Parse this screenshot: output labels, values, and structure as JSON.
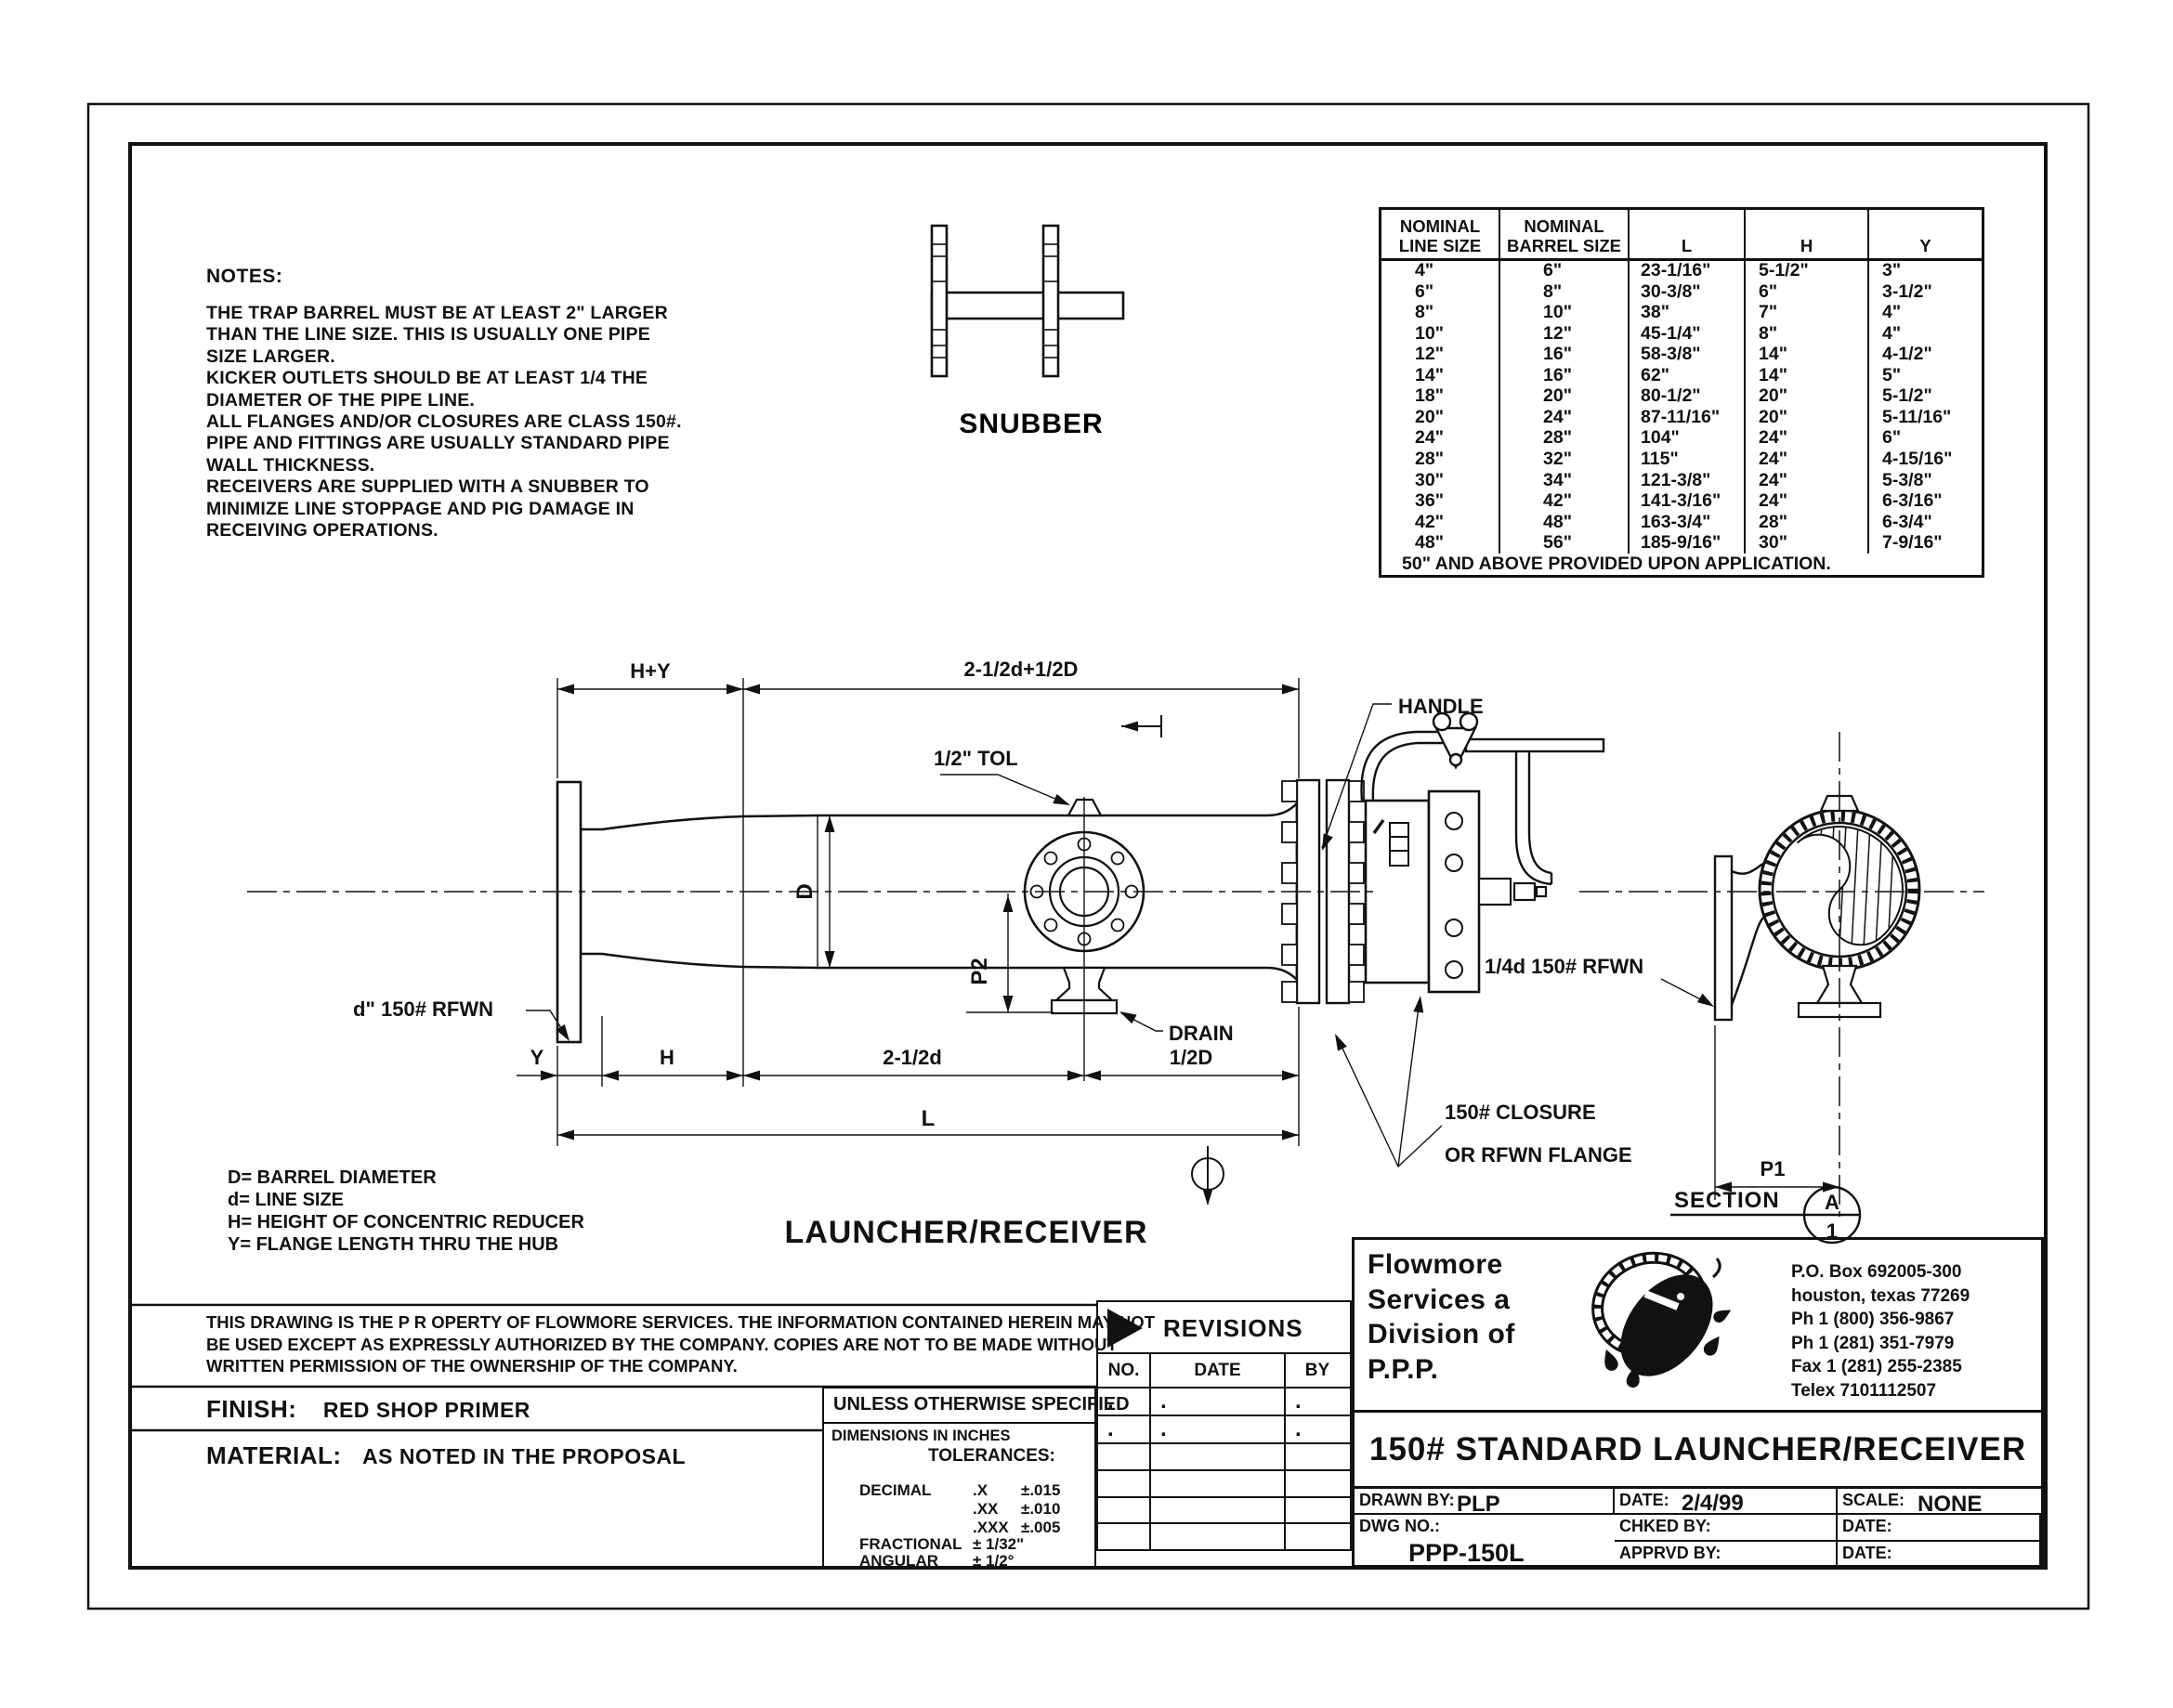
{
  "notes": {
    "heading": "NOTES:",
    "lines": [
      "THE TRAP BARREL MUST BE AT LEAST 2\" LARGER",
      "THAN THE LINE SIZE. THIS IS USUALLY ONE PIPE",
      "SIZE LARGER.",
      "KICKER OUTLETS SHOULD BE AT LEAST 1/4 THE",
      "DIAMETER OF THE PIPE LINE.",
      "ALL FLANGES AND/OR CLOSURES ARE CLASS 150#.",
      "PIPE AND FITTINGS ARE USUALLY STANDARD PIPE",
      "WALL THICKNESS.",
      "RECEIVERS ARE SUPPLIED WITH A SNUBBER TO",
      "MINIMIZE LINE STOPPAGE AND PIG DAMAGE IN",
      "RECEIVING OPERATIONS."
    ]
  },
  "size_table": {
    "headers": [
      [
        "NOMINAL",
        "LINE SIZE"
      ],
      [
        "NOMINAL",
        "BARREL SIZE"
      ],
      [
        "",
        "L"
      ],
      [
        "",
        "H"
      ],
      [
        "",
        "Y"
      ]
    ],
    "rows": [
      [
        "4\"",
        "6\"",
        "23-1/16\"",
        "5-1/2\"",
        "3\""
      ],
      [
        "6\"",
        "8\"",
        "30-3/8\"",
        "6\"",
        "3-1/2\""
      ],
      [
        "8\"",
        "10\"",
        "38\"",
        "7\"",
        "4\""
      ],
      [
        "10\"",
        "12\"",
        "45-1/4\"",
        "8\"",
        "4\""
      ],
      [
        "12\"",
        "16\"",
        "58-3/8\"",
        "14\"",
        "4-1/2\""
      ],
      [
        "14\"",
        "16\"",
        "62\"",
        "14\"",
        "5\""
      ],
      [
        "18\"",
        "20\"",
        "80-1/2\"",
        "20\"",
        "5-1/2\""
      ],
      [
        "20\"",
        "24\"",
        "87-11/16\"",
        "20\"",
        "5-11/16\""
      ],
      [
        "24\"",
        "28\"",
        "104\"",
        "24\"",
        "6\""
      ],
      [
        "28\"",
        "32\"",
        "115\"",
        "24\"",
        "4-15/16\""
      ],
      [
        "30\"",
        "34\"",
        "121-3/8\"",
        "24\"",
        "5-3/8\""
      ],
      [
        "36\"",
        "42\"",
        "141-3/16\"",
        "24\"",
        "6-3/16\""
      ],
      [
        "42\"",
        "48\"",
        "163-3/4\"",
        "28\"",
        "6-3/4\""
      ],
      [
        "48\"",
        "56\"",
        "185-9/16\"",
        "30\"",
        "7-9/16\""
      ]
    ],
    "footer": "50\" AND ABOVE PROVIDED UPON APPLICATION."
  },
  "drawing": {
    "title": "LAUNCHER/RECEIVER",
    "snubber_label": "SNUBBER",
    "dim_top_left": "H+Y",
    "dim_top_right": "2-1/2d+1/2D",
    "tol": "1/2\" TOL",
    "barrel_dia": "D",
    "p2": "P2",
    "drain": "DRAIN",
    "handle": "HANDLE",
    "closure_line1": "150# CLOSURE",
    "closure_line2": "OR RFWN FLANGE",
    "quarter_rfwn": "1/4d 150# RFWN",
    "line_rfwn": "d\" 150# RFWN",
    "dim_y": "Y",
    "dim_h": "H",
    "dim_25d": "2-1/2d",
    "dim_12d": "1/2D",
    "dim_l": "L",
    "dim_p1": "P1",
    "section_label": "SECTION",
    "section_letter": "A",
    "section_number": "1"
  },
  "legend": {
    "lines": [
      "D=  BARREL DIAMETER",
      "d=  LINE SIZE",
      "H=  HEIGHT OF CONCENTRIC REDUCER",
      "Y=  FLANGE LENGTH THRU THE HUB"
    ]
  },
  "property_note": {
    "lines": [
      "THIS DRAWING IS THE P R OPERTY OF FLOWMORE SERVICES.   THE INFORMATION CONTAINED HEREIN MAY NOT",
      "BE USED EXCEPT AS EXPRESSLY AUTHORIZED BY THE COMPANY. COPIES ARE NOT TO BE MADE WITHOUT",
      "WRITTEN PERMISSION OF THE OWNERSHIP OF THE COMPANY."
    ]
  },
  "finish": {
    "label": "FINISH:",
    "value": "RED SHOP PRIMER"
  },
  "material": {
    "label": "MATERIAL:",
    "value": "AS NOTED IN THE PROPOSAL"
  },
  "tolerances": {
    "unless": "UNLESS OTHERWISE SPECIFIED",
    "dims_in": "DIMENSIONS IN INCHES",
    "heading": "TOLERANCES:",
    "decimal_label": "DECIMAL",
    "dec_rows": [
      {
        "k": ".X",
        "v": "±.015"
      },
      {
        "k": ".XX",
        "v": "±.010"
      },
      {
        "k": ".XXX",
        "v": "±.005"
      }
    ],
    "fractional_label": "FRACTIONAL",
    "fractional_value": "± 1/32\"",
    "angular_label": "ANGULAR",
    "angular_value": "± 1/2°"
  },
  "revisions": {
    "title": "REVISIONS",
    "columns": [
      "NO.",
      "DATE",
      "BY"
    ],
    "rows": [
      [
        ".",
        ".",
        "."
      ],
      [
        ".",
        ".",
        "."
      ],
      [
        "",
        "",
        ""
      ],
      [
        "",
        "",
        ""
      ],
      [
        "",
        "",
        ""
      ],
      [
        "",
        "",
        ""
      ]
    ]
  },
  "title_block": {
    "company_lines": [
      "Flowmore",
      "Services a",
      "Division of",
      "P.P.P."
    ],
    "address_lines": [
      "P.O. Box 692005-300",
      "houston, texas 77269",
      "Ph 1 (800) 356-9867",
      "Ph 1 (281) 351-7979",
      "Fax 1 (281) 255-2385",
      "Telex 7101112507"
    ],
    "drawing_title": "150# STANDARD LAUNCHER/RECEIVER",
    "drawn_by_label": "DRAWN BY:",
    "drawn_by": "PLP",
    "date1_label": "DATE:",
    "date1": "2/4/99",
    "scale_label": "SCALE:",
    "scale": "NONE",
    "chked_label": "CHKED BY:",
    "date2_label": "DATE:",
    "dwg_label": "DWG NO.:",
    "dwg_no": "PPP-150L",
    "apprvd_label": "APPRVD BY:",
    "date3_label": "DATE:"
  }
}
